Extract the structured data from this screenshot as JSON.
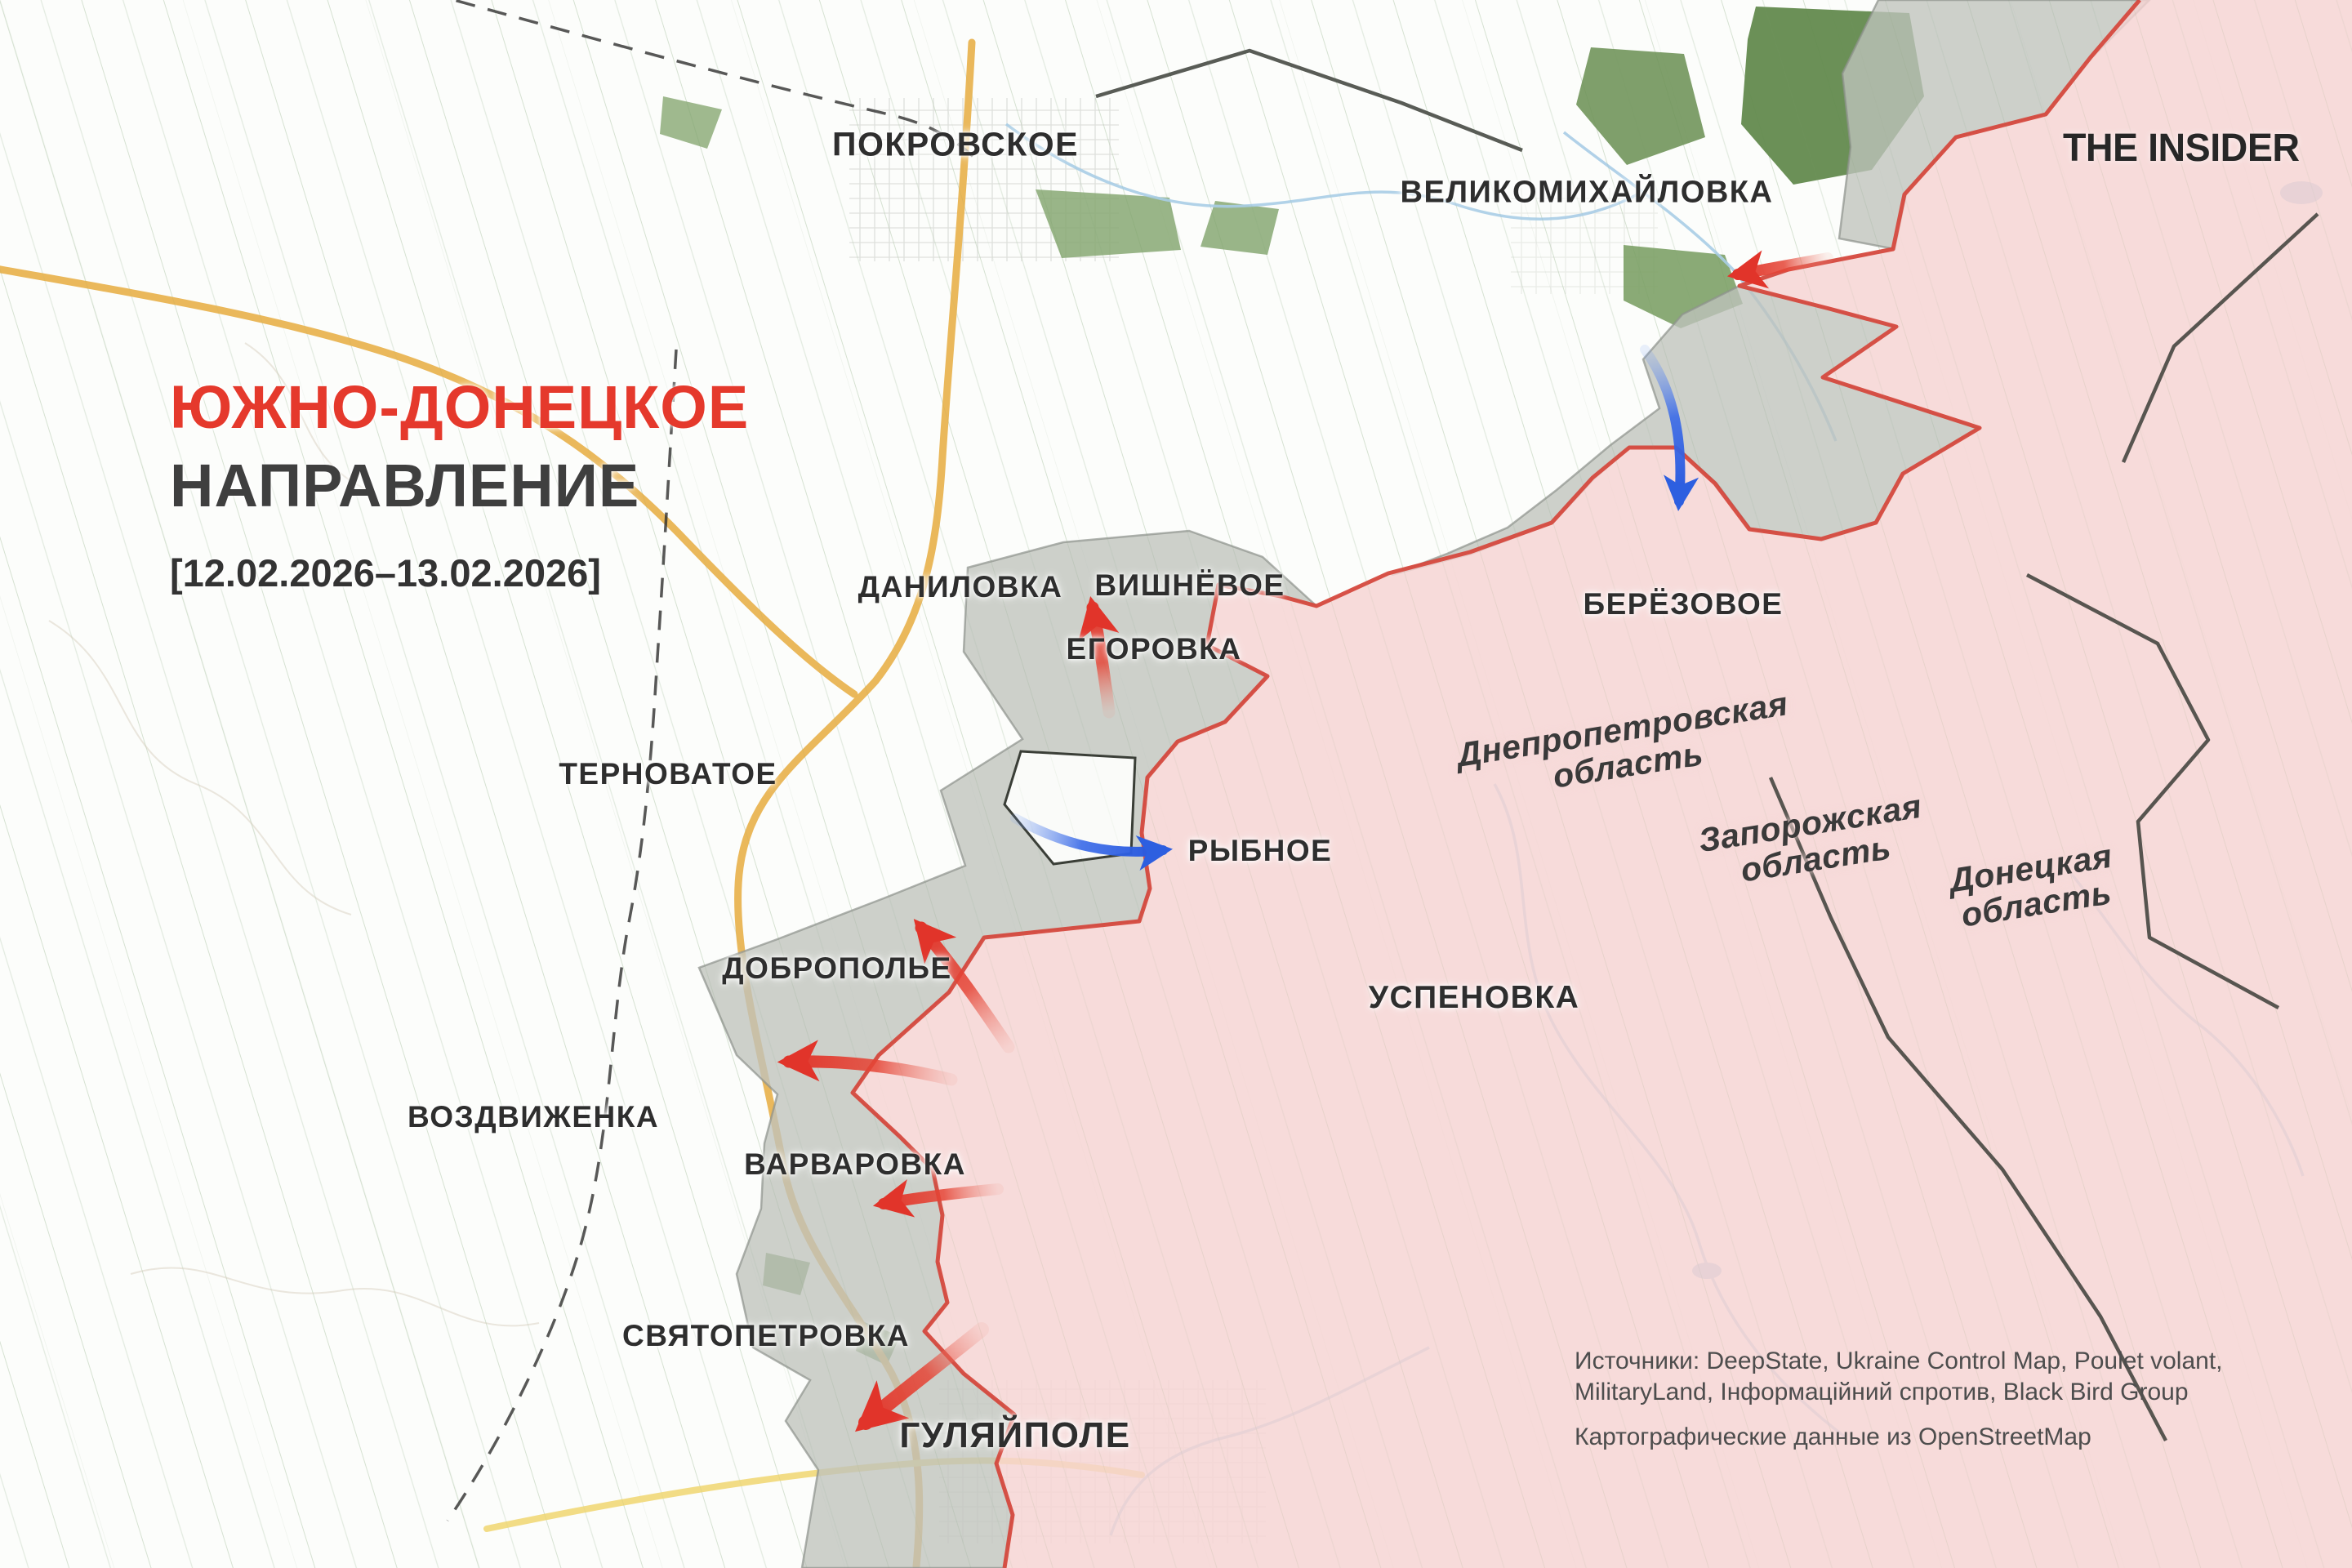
{
  "branding": {
    "logo_text": "THE INSIDER"
  },
  "header": {
    "title_line1": "ЮЖНО-ДОНЕЦКОЕ",
    "title_line2": "НАПРАВЛЕНИЕ",
    "date_range": "[12.02.2026–13.02.2026]"
  },
  "map": {
    "towns": [
      {
        "id": "pokrovskoe",
        "label": "ПОКРОВСКОЕ"
      },
      {
        "id": "velikomikhaylovka",
        "label": "ВЕЛИКОМИХАЙЛОВКА"
      },
      {
        "id": "danilovka",
        "label": "ДАНИЛОВКА"
      },
      {
        "id": "vishnyovoe",
        "label": "ВИШНЁВОЕ"
      },
      {
        "id": "egorovka",
        "label": "ЕГОРОВКА"
      },
      {
        "id": "beryozovoe",
        "label": "БЕРЁЗОВОЕ"
      },
      {
        "id": "ternovatoe",
        "label": "ТЕРНОВАТОЕ"
      },
      {
        "id": "rybnoe",
        "label": "РЫБНОЕ"
      },
      {
        "id": "dobropolye",
        "label": "ДОБРОПОЛЬЕ"
      },
      {
        "id": "uspenovka",
        "label": "УСПЕНОВКА"
      },
      {
        "id": "vozdvizhenka",
        "label": "ВОЗДВИЖЕНКА"
      },
      {
        "id": "varvarovka",
        "label": "ВАРВАРОВКА"
      },
      {
        "id": "svyatopetrovka",
        "label": "СВЯТОПЕТРОВКА"
      },
      {
        "id": "gulyaypole",
        "label": "ГУЛЯЙПОЛЕ"
      }
    ],
    "regions": [
      {
        "id": "dnepropetrovskaya",
        "line1": "Днепропетровская",
        "line2": "область"
      },
      {
        "id": "zaporozhskaya",
        "line1": "Запорожская",
        "line2": "область"
      },
      {
        "id": "donetskaya",
        "line1": "Донецкая",
        "line2": "область"
      }
    ],
    "zones": {
      "occupied_fill": "#f5d3d2",
      "occupied_border": "#d5493e",
      "contested_fill": "#bfc3bd"
    },
    "arrow_colors": {
      "attack": "#e1342a",
      "counter": "#2d5fe0"
    },
    "arrows": [
      {
        "id": "arrow-velikomikhaylovka-west",
        "color": "red"
      },
      {
        "id": "arrow-berezovoe-south",
        "color": "blue"
      },
      {
        "id": "arrow-egorovka-north",
        "color": "red"
      },
      {
        "id": "arrow-rybnoe-east",
        "color": "blue"
      },
      {
        "id": "arrow-dobropolye-northwest",
        "color": "red"
      },
      {
        "id": "arrow-dobropolye-west",
        "color": "red"
      },
      {
        "id": "arrow-varvarovka-west",
        "color": "red"
      },
      {
        "id": "arrow-gulyaypole-southwest",
        "color": "red"
      }
    ]
  },
  "attribution": {
    "sources_line1": "Источники: DeepState, Ukraine Control Map, Poulet volant,",
    "sources_line2": "MilitaryLand, Інформаційний спротив, Black Bird Group",
    "cartography": "Картографические данные из OpenStreetMap"
  }
}
